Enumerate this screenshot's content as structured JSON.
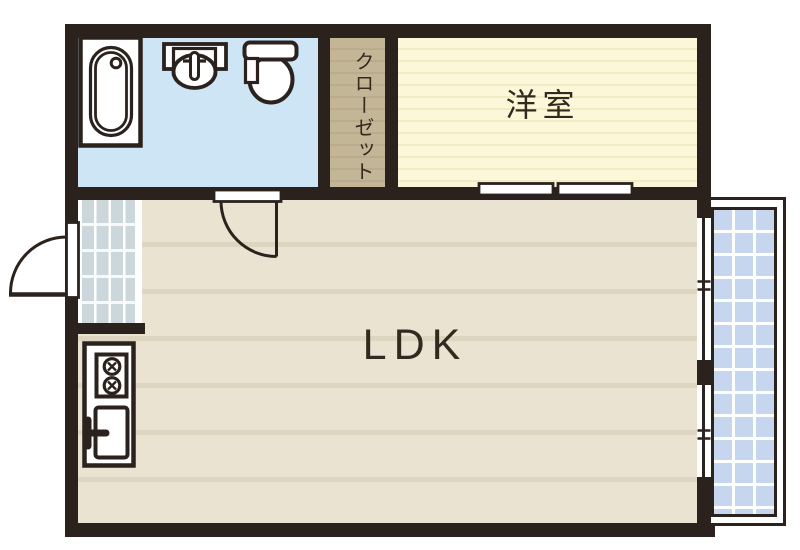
{
  "floor_plan": {
    "kind": "apartment-floor-plan",
    "labels": {
      "ldk": "LDK",
      "western_room": "洋室",
      "closet": "クローゼット"
    },
    "fixtures": [
      "bathtub",
      "washbasin",
      "toilet",
      "kitchen-stove",
      "kitchen-sink",
      "entrance-door",
      "interior-swing-door",
      "sliding-door",
      "balcony-windows",
      "balcony"
    ],
    "colors": {
      "wall": "#2b221e",
      "bathroom": "#cee5f6",
      "closet": "#c3b697",
      "closet_stripe": "#b9ab8b",
      "western": "#fcf7d8",
      "western_stripe": "#f2ebc3",
      "ldk": "#eae3d1",
      "ldk_stripe": "#ddd5bf",
      "balcony": "#c5d6ee",
      "entrance": "#cbd7da",
      "ink": "#33291f"
    }
  }
}
